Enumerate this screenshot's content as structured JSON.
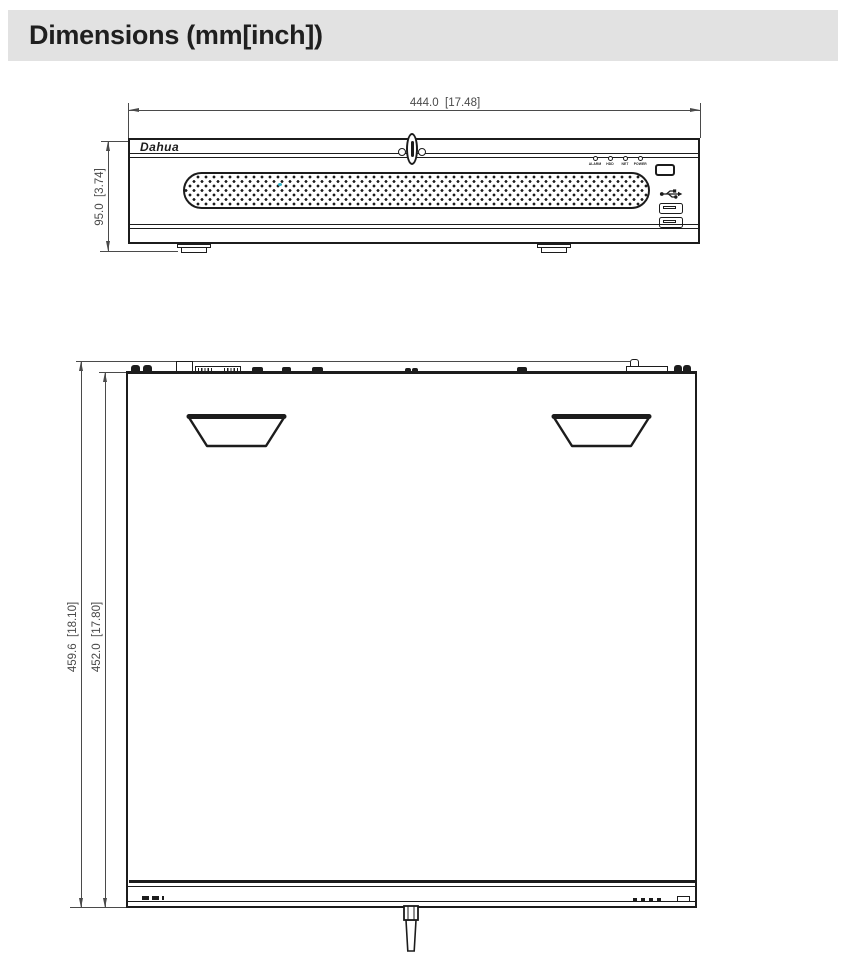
{
  "header": {
    "title": "Dimensions (mm[inch])"
  },
  "front_view": {
    "width_dim": "444.0  [17.48]",
    "height_dim": "95.0  [3.74]",
    "logo_text": "Dahua",
    "led_labels": [
      "ALARM",
      "HDD",
      "NET",
      "POWER"
    ],
    "icons": {
      "lock": "lock-keyhole-icon",
      "usb": "usb-icon",
      "ir_window": "ir-window-icon"
    }
  },
  "top_view": {
    "outer_dim": "459.6  [18.10]",
    "inner_dim": "452.0  [17.80]",
    "icons": {
      "key": "lock-key-icon",
      "handles": "handle-recess"
    }
  },
  "colors": {
    "ink": "#1c1c1c",
    "dim_line": "#4a4a4a",
    "header_bg": "#e2e2e2",
    "grille_accent_dot": "#35b6c9"
  }
}
